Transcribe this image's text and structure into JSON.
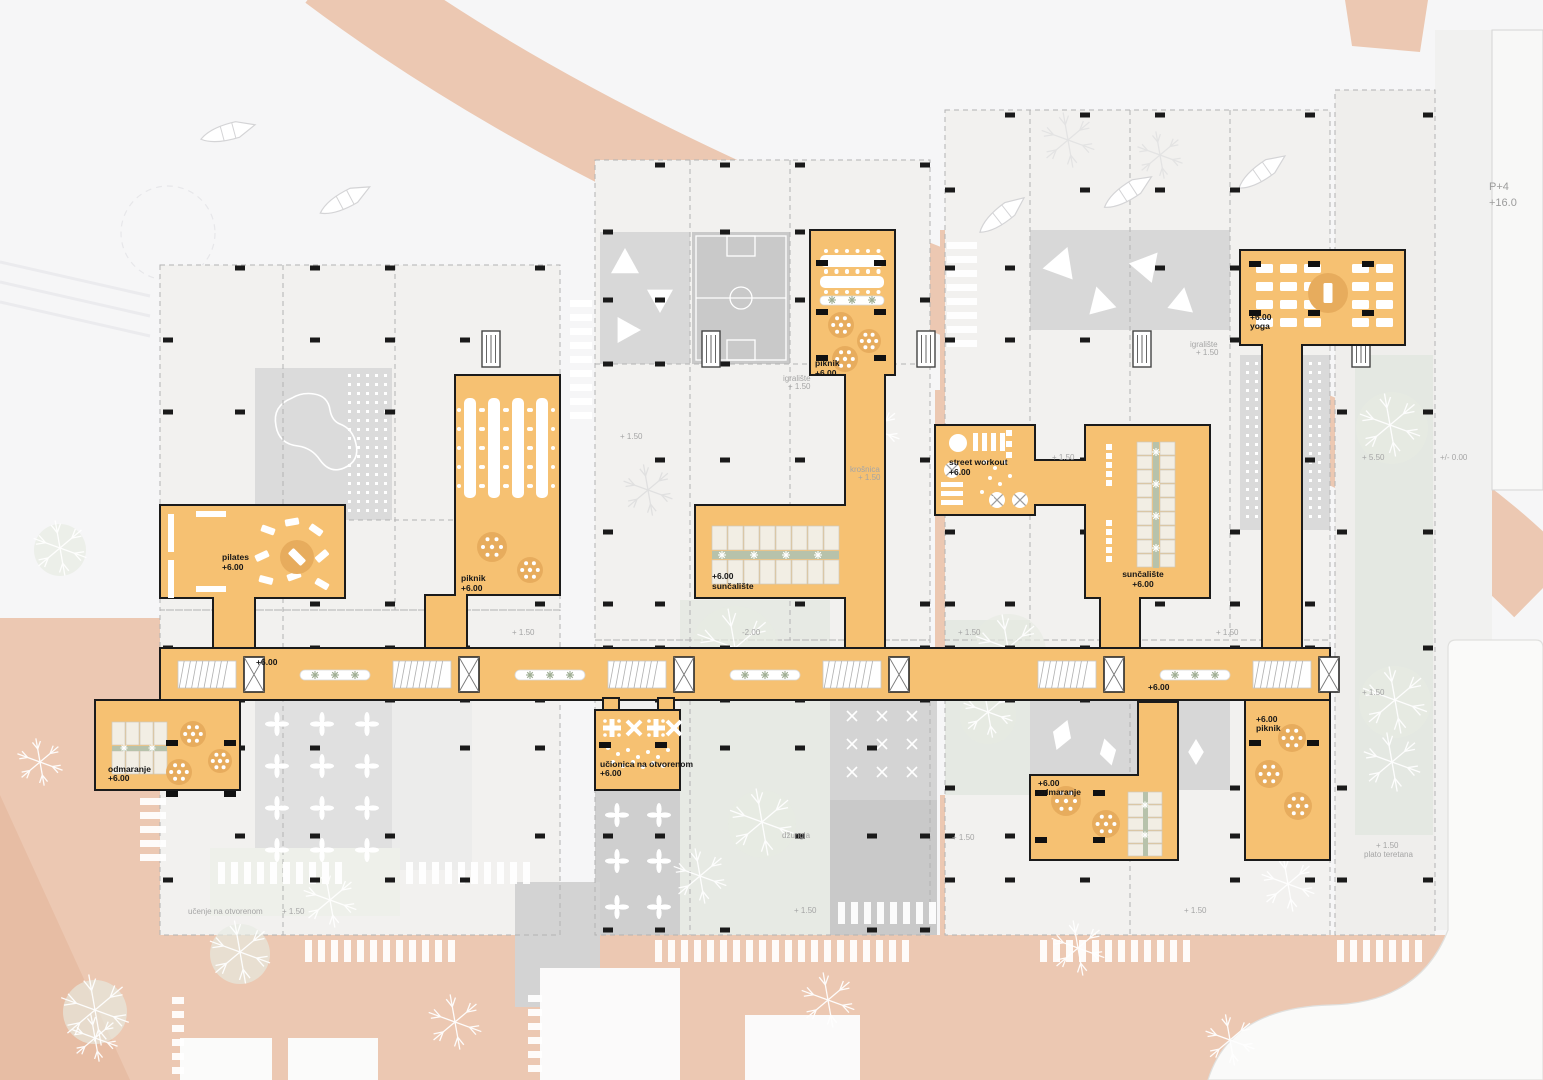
{
  "platforms": {
    "pilates": {
      "name": "pilates",
      "elev": "+6.00"
    },
    "piknik_left": {
      "name": "piknik",
      "elev": "+6.00"
    },
    "piknik_top": {
      "name": "piknik",
      "elev": "+6.00"
    },
    "suncaliste_center": {
      "name": "sunčalište",
      "elev": "+6.00"
    },
    "street_workout": {
      "name": "street workout",
      "elev": "+6.00"
    },
    "suncaliste_right": {
      "name": "sunčalište",
      "elev": "+6.00"
    },
    "yoga": {
      "name": "yoga",
      "elev": "+6.00"
    },
    "odmaranje_left": {
      "name": "odmaranje",
      "elev": "+6.00"
    },
    "ucionica": {
      "name": "učionica na otvorenom",
      "elev": "+6.00"
    },
    "odmaranje_right": {
      "name": "odmaranje",
      "elev": "+6.00"
    },
    "piknik_right": {
      "name": "piknik",
      "elev": "+6.00"
    },
    "corridor": {
      "elev_left": "+6.00",
      "elev_right": "+6.00"
    }
  },
  "ground": {
    "e150": "+ 1.50",
    "e_minus200": "-2.00",
    "e550": "+ 5.50",
    "e000": "+/- 0.00",
    "igraliste": "igralište",
    "krosnica": "krošnica",
    "dzungla": "džungla",
    "ucenje": "učenje na otvorenom",
    "plato_teretana": "plato teretana"
  },
  "buildings": {
    "p4": {
      "name": "P+4",
      "elev": "+16.0"
    }
  },
  "colors": {
    "platform": "#f6c172",
    "road": "#ecc8b2",
    "water": "#f6f6f7",
    "green": "#b7c2ab"
  }
}
